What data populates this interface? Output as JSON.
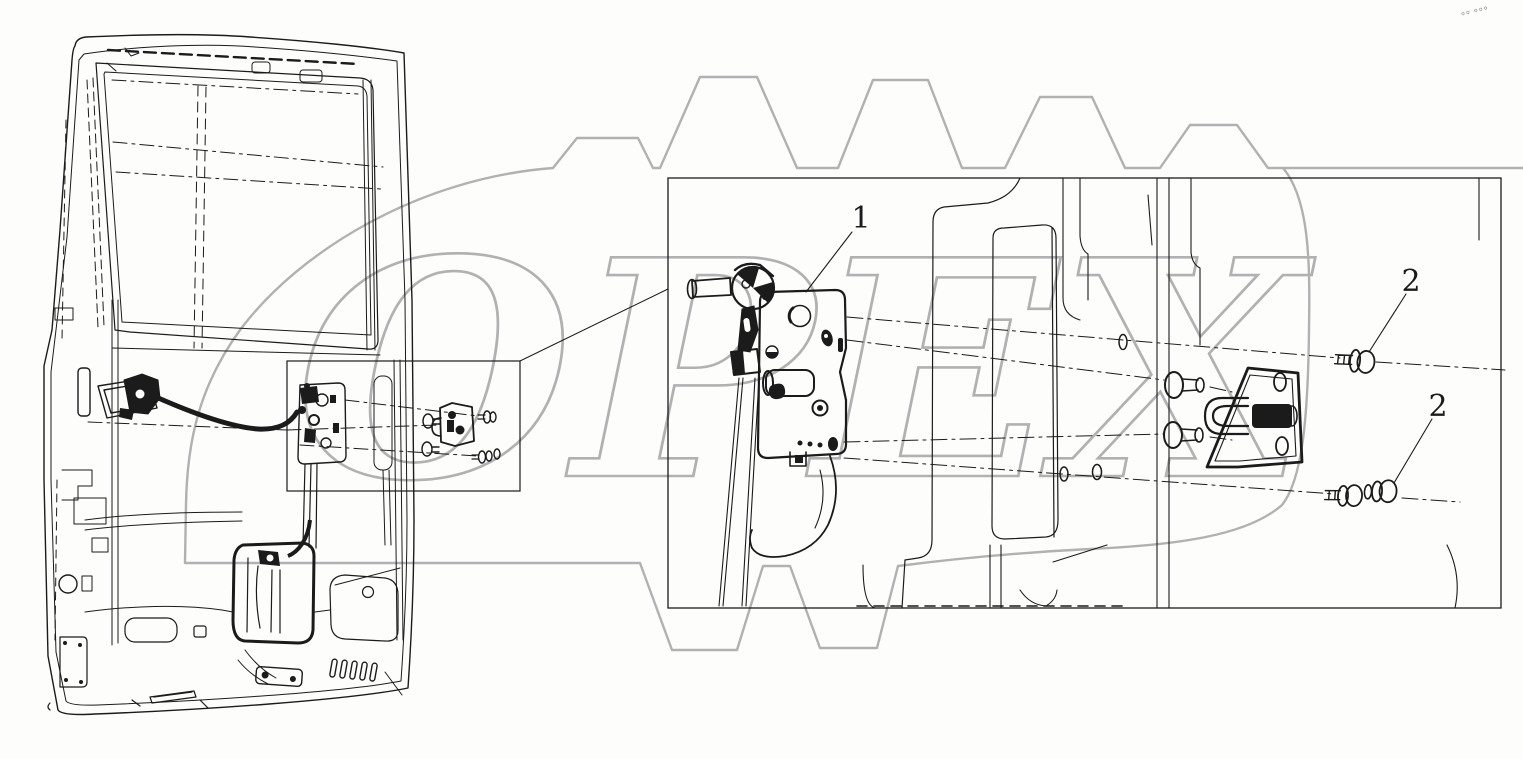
{
  "canvas": {
    "width": 1523,
    "height": 759,
    "background": "#fdfdfc"
  },
  "colors": {
    "line": "#1b1b1b",
    "watermark": "#b1b1b1"
  },
  "watermark": {
    "text": "OPEX",
    "corner_mark": "°° °°°"
  },
  "callouts": {
    "lock": "1",
    "bolt_upper": "2",
    "bolt_lower": "2"
  }
}
